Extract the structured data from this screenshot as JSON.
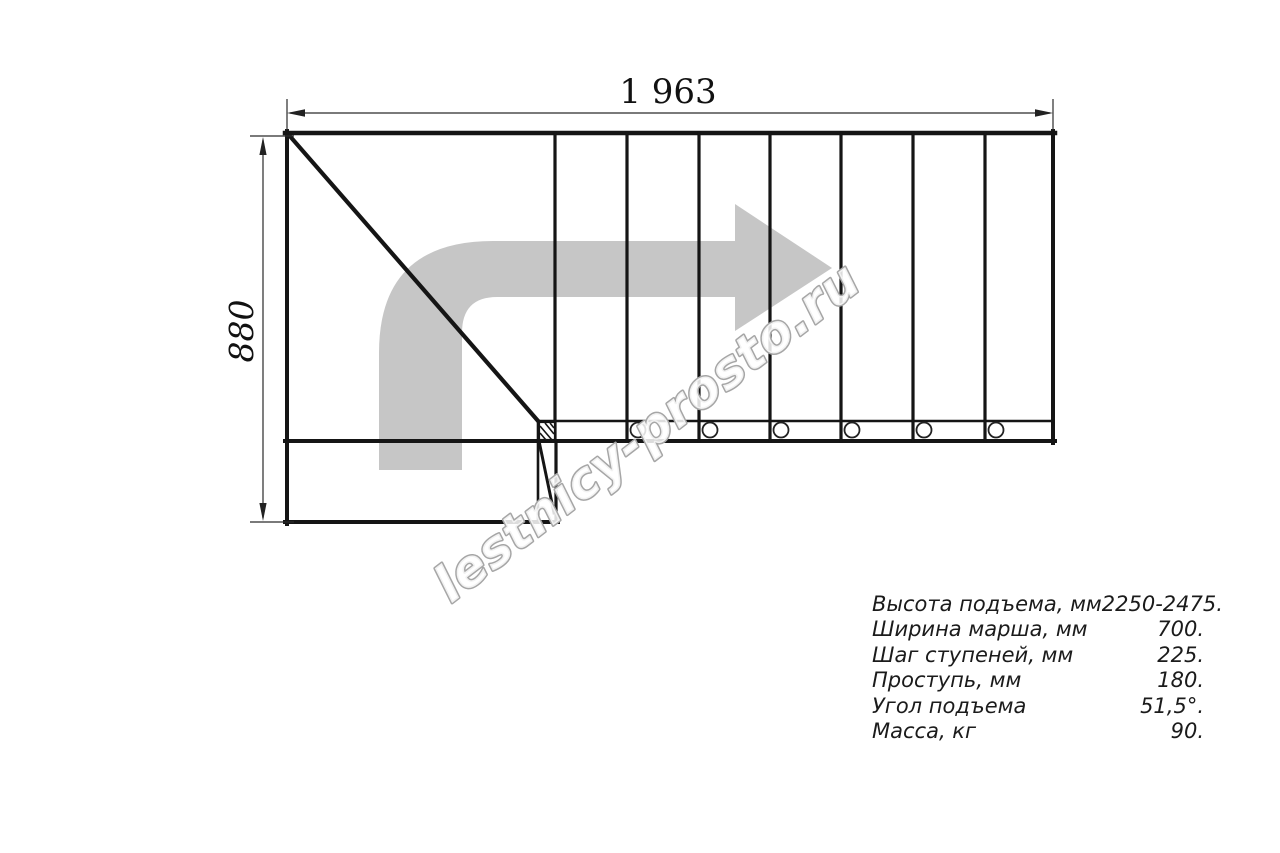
{
  "drawing": {
    "watermark": "lestnicy-prosto.ru",
    "dimensions": {
      "width_label": "1 963",
      "height_label": "880"
    },
    "colors": {
      "line": "#151515",
      "dim_line": "#2a2a2a",
      "arrow_fill": "#c6c6c6",
      "watermark_fill": "rgba(255,255,255,0.85)",
      "watermark_stroke": "#a6a6a6"
    },
    "icons": [
      "direction-arrow-icon"
    ]
  },
  "specs": {
    "rows": [
      {
        "label": "Высота подъема, мм",
        "value": "2250-2475."
      },
      {
        "label": "Ширина марша, мм",
        "value": "700."
      },
      {
        "label": "Шаг ступеней, мм",
        "value": "225."
      },
      {
        "label": "Проступь, мм",
        "value": "180."
      },
      {
        "label": "Угол подъема",
        "value": "51,5°."
      },
      {
        "label": "Масса, кг",
        "value": "90."
      }
    ]
  }
}
